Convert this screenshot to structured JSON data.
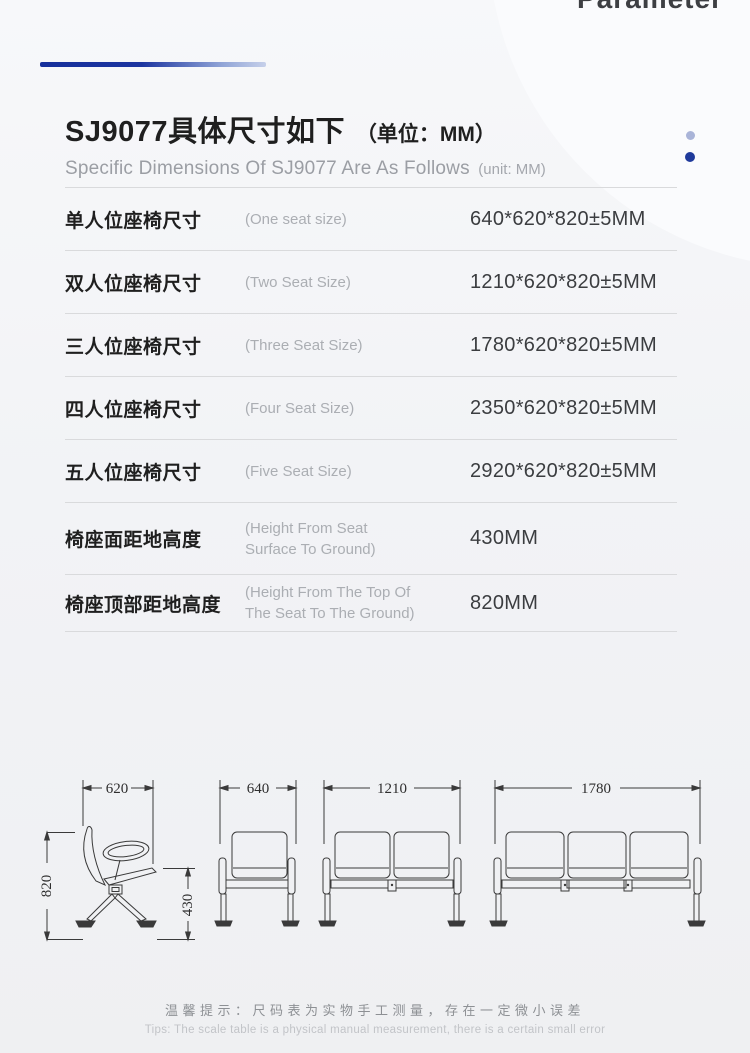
{
  "header": {
    "previous_section_fragment": "Parameter"
  },
  "title": {
    "zh": "SJ9077具体尺寸如下",
    "unit_zh": "（单位：MM）",
    "en": "Specific Dimensions Of SJ9077 Are As Follows",
    "unit_en": "(unit: MM)"
  },
  "table": {
    "rows": [
      {
        "label": "单人位座椅尺寸",
        "en": "(One seat size)",
        "value": "640*620*820±5MM"
      },
      {
        "label": "双人位座椅尺寸",
        "en": "(Two Seat Size)",
        "value": "1210*620*820±5MM"
      },
      {
        "label": "三人位座椅尺寸",
        "en": "(Three Seat Size)",
        "value": "1780*620*820±5MM"
      },
      {
        "label": "四人位座椅尺寸",
        "en": "(Four Seat Size)",
        "value": "2350*620*820±5MM"
      },
      {
        "label": "五人位座椅尺寸",
        "en": "(Five Seat Size)",
        "value": "2920*620*820±5MM"
      },
      {
        "label": "椅座面距地高度",
        "en": "(Height From Seat\nSurface To Ground)",
        "value": "430MM"
      },
      {
        "label": "椅座顶部距地高度",
        "en": "(Height From The Top Of\nThe Seat To The Ground)",
        "value": "820MM"
      }
    ]
  },
  "drawings": {
    "side": {
      "width": "620",
      "height": "820",
      "seat_height": "430"
    },
    "front_one": {
      "width": "640"
    },
    "front_two": {
      "width": "1210"
    },
    "front_three": {
      "width": "1780"
    }
  },
  "tips": {
    "zh": "温馨提示：尺码表为实物手工测量，存在一定微小误差",
    "en": "Tips: The scale table is a physical manual measurement, there is a certain small error"
  },
  "colors": {
    "accent_dark": "#16309c",
    "accent_light": "#a9b4d8",
    "dot_dark": "#1f3a9b",
    "dot_light": "#a9b4d8"
  }
}
